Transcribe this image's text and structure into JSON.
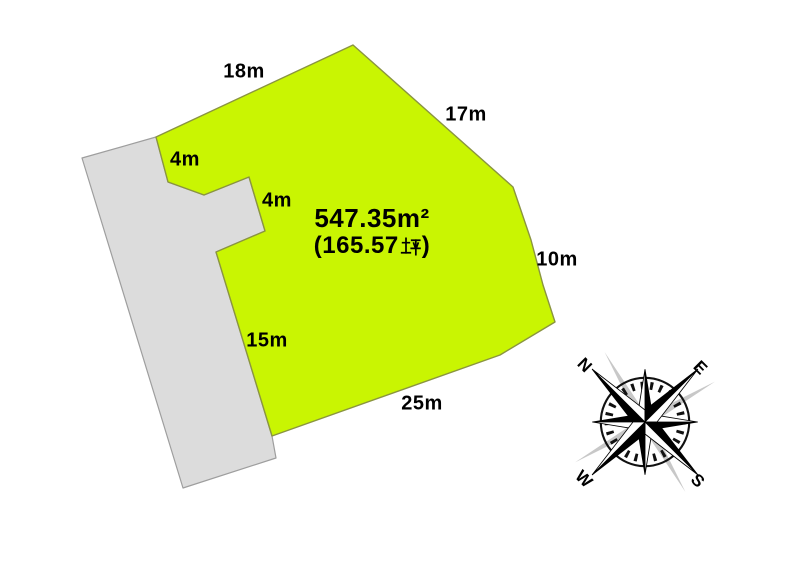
{
  "colors": {
    "parcel_fill": "#c9f502",
    "parcel_stroke": "#8a9440",
    "road_fill": "#dcdcdc",
    "road_stroke": "#9e9e9e",
    "text_color": "#000000",
    "compass_shadow": "#c8c8c8"
  },
  "parcel": {
    "area_sqm": "547.35m²",
    "area_tsubo_open": "(165.57",
    "area_tsubo_unit": "坪",
    "area_tsubo_close": ")"
  },
  "dimensions": {
    "top": "18m",
    "upper_right": "17m",
    "setback_upper": "4m",
    "setback_inner": "4m",
    "right": "10m",
    "left": "15m",
    "bottom": "25m"
  },
  "compass": {
    "north": "N",
    "east": "E",
    "south": "S",
    "west": "W"
  }
}
